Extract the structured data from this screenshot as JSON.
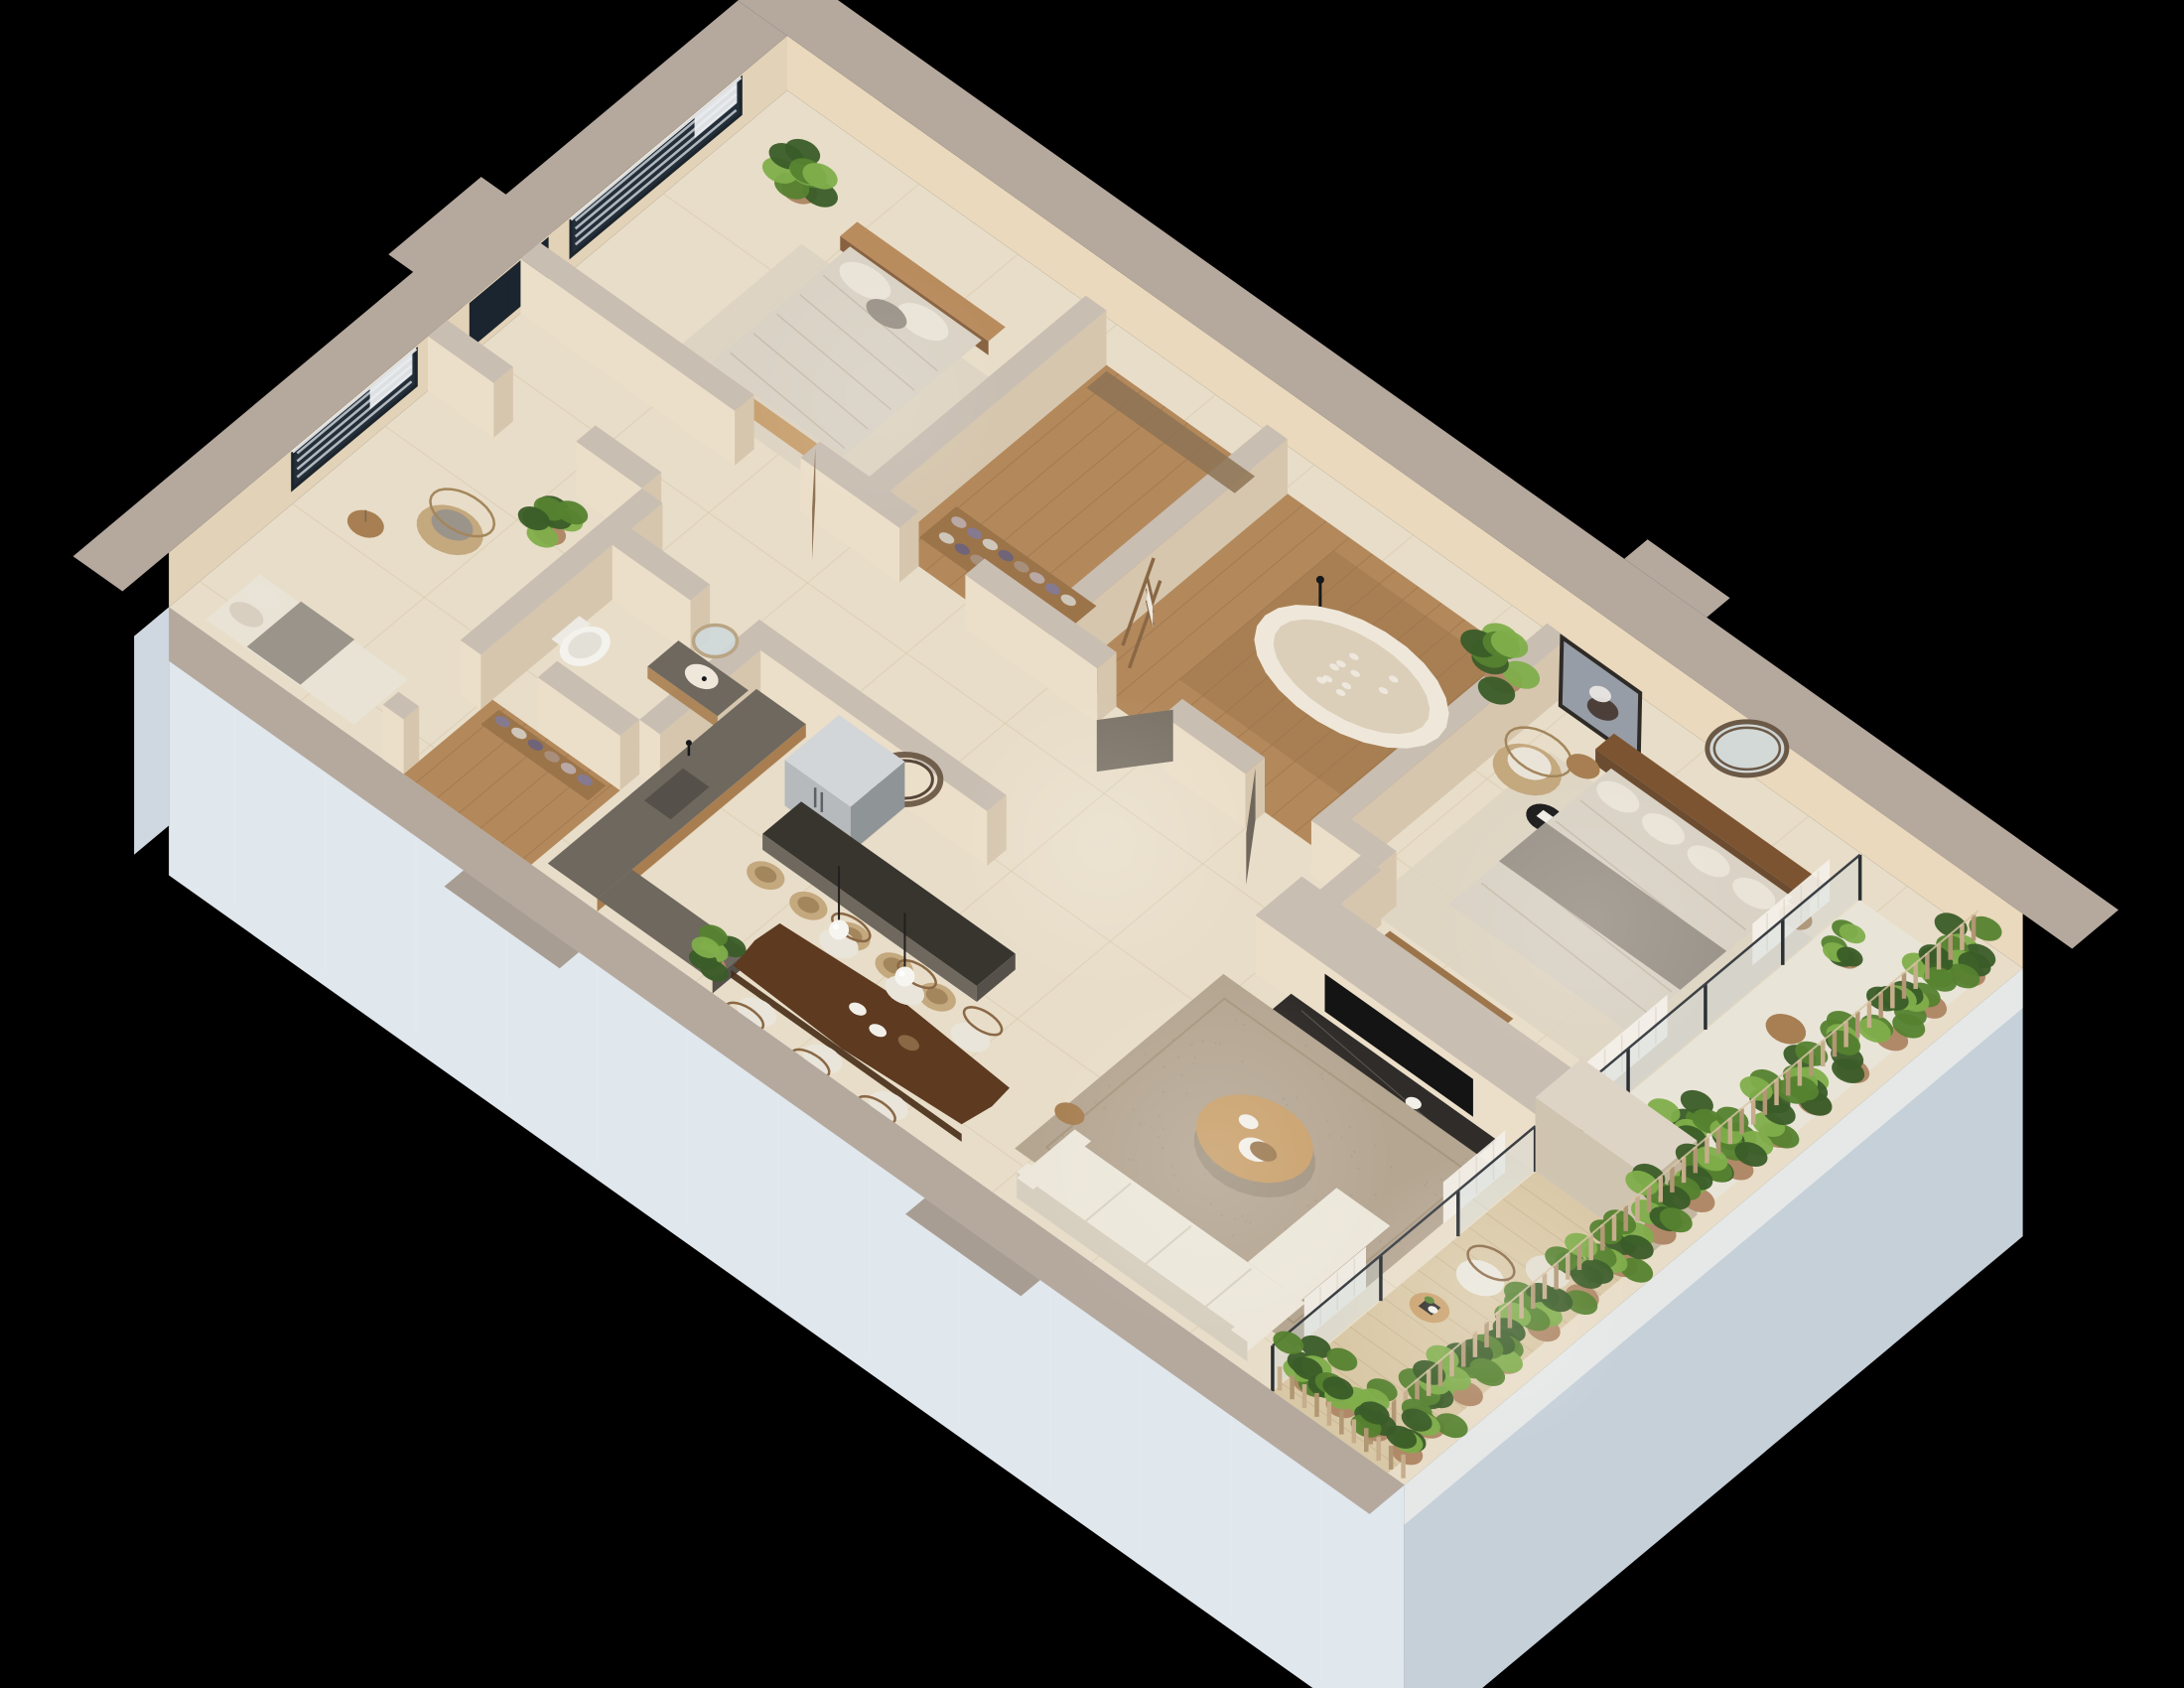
{
  "scene": {
    "type": "isometric-3d-floor-plan-render",
    "background": "#000000",
    "rooms": [
      {
        "id": "second-bedroom",
        "floor": "tile"
      },
      {
        "id": "walk-in-closet",
        "floor": "wood"
      },
      {
        "id": "main-bathroom",
        "floor": "wood"
      },
      {
        "id": "master-bedroom",
        "floor": "tile"
      },
      {
        "id": "hallway",
        "floor": "tile"
      },
      {
        "id": "study-lounge",
        "floor": "tile"
      },
      {
        "id": "guest-bathroom",
        "floor": "tile"
      },
      {
        "id": "shoe-closet",
        "floor": "wood"
      },
      {
        "id": "kitchen",
        "floor": "tile"
      },
      {
        "id": "dining-area",
        "floor": "tile"
      },
      {
        "id": "living-area",
        "floor": "tile"
      },
      {
        "id": "master-balcony",
        "floor": "stone"
      },
      {
        "id": "living-balcony",
        "floor": "deck"
      }
    ],
    "counts": {
      "beds": 2,
      "bathrooms": 2,
      "balconies": 2,
      "windows": 2,
      "dining_chairs": 6,
      "bar_stools": 5,
      "pendant_lights": 2,
      "towel_stacks": 5,
      "shoe_pairs": 8,
      "armchairs": 2,
      "sofas": 1,
      "bathtubs": 1,
      "refrigerators": 1,
      "tv_screens": 1,
      "round_mirrors": 3,
      "planter_rows": 2,
      "balcony_chairs": 2,
      "door_leaves": 3,
      "glass_post_rows": 2
    },
    "colors": {
      "background": "#000000",
      "cap_ext": "#b5a99e",
      "cap_int": "#c9beb2",
      "wall_inner_ne": "#ead9bd",
      "wall_inner_nw": "#e2d2b8",
      "wall_face_sw": "#ecdfc9",
      "wall_face_se": "#d6c6ae",
      "wall_outer": "#e0e7ed",
      "wall_outer_shade": "#c6d0d9",
      "floor_tile": "#e8ddc8",
      "grout": "#d6c9b0",
      "wood_floor": "#b3895c",
      "wood_dark": "#9c744a",
      "plank_line": "#8a6740",
      "deck": "#d9c8a6",
      "deck_line": "#c2ae8a",
      "stone_balcony": "#e9e4d8",
      "rug_beige": "#ddd3c2",
      "rug_living": "#b5a692",
      "rug_border": "#a29278",
      "duvet": "#d9d2c5",
      "duvet_shad": "#c3b9a8",
      "throw_gray": "#9b948a",
      "pillow": "#eae4d8",
      "headboard": "#b98c5e",
      "headboard_dark": "#7d5431",
      "bench_wood": "#c9a272",
      "glass_win": "#232e39",
      "blind": "#c9d0d6",
      "frame_dark": "#1c242c",
      "roller": "#eef0f2",
      "shaft": "#1b2530",
      "door_wood": "#8d7354",
      "counter": "#6e685e",
      "counter_top": "#55504a",
      "island_top": "#38352f",
      "cabinet": "#a87e50",
      "fridge": "#b6babd",
      "fridge_dark": "#8f9497",
      "fridge_top": "#d3d6d8",
      "tub_rim": "#efe8da",
      "tub_in": "#dccfba",
      "black": "#16181a",
      "plant_dark": "#3a5c28",
      "plant_mid": "#55822f",
      "plant_light": "#7fae4b",
      "pot": "#b08968",
      "planter_wood": "#c6ad8c",
      "planter_wood_dark": "#b19774",
      "planter_wall": "#eceeea",
      "curtain": "#f4f0e8",
      "glass_balc": "#c3d4da",
      "sofa": "#ece7da",
      "sofa_shad": "#d6cfbf",
      "coffee": "#c9a06b",
      "dining": "#5d3a20",
      "dining_edge": "#462b15",
      "chair_seat": "#e9e5da",
      "chair_wood": "#8a6845",
      "stool": "#c4a87e",
      "stool_dark": "#a3865c",
      "marble": "#2f2c29",
      "marble_vein": "#6a645c",
      "stump": "#a77f52",
      "stump_dark": "#8a6540",
      "art_bg": "#969da6",
      "art_fig": "#4c3f39",
      "feather": "#e8e6e2",
      "ring_wood": "#6b5947",
      "towel": "#f2efe8",
      "mirror_glass": "#cfd8da",
      "travertine_cap": "#ded4c6",
      "travertine_a": "#cfc4b0",
      "travertine_b": "#c2b6a0",
      "sun": "#ffffff"
    }
  }
}
